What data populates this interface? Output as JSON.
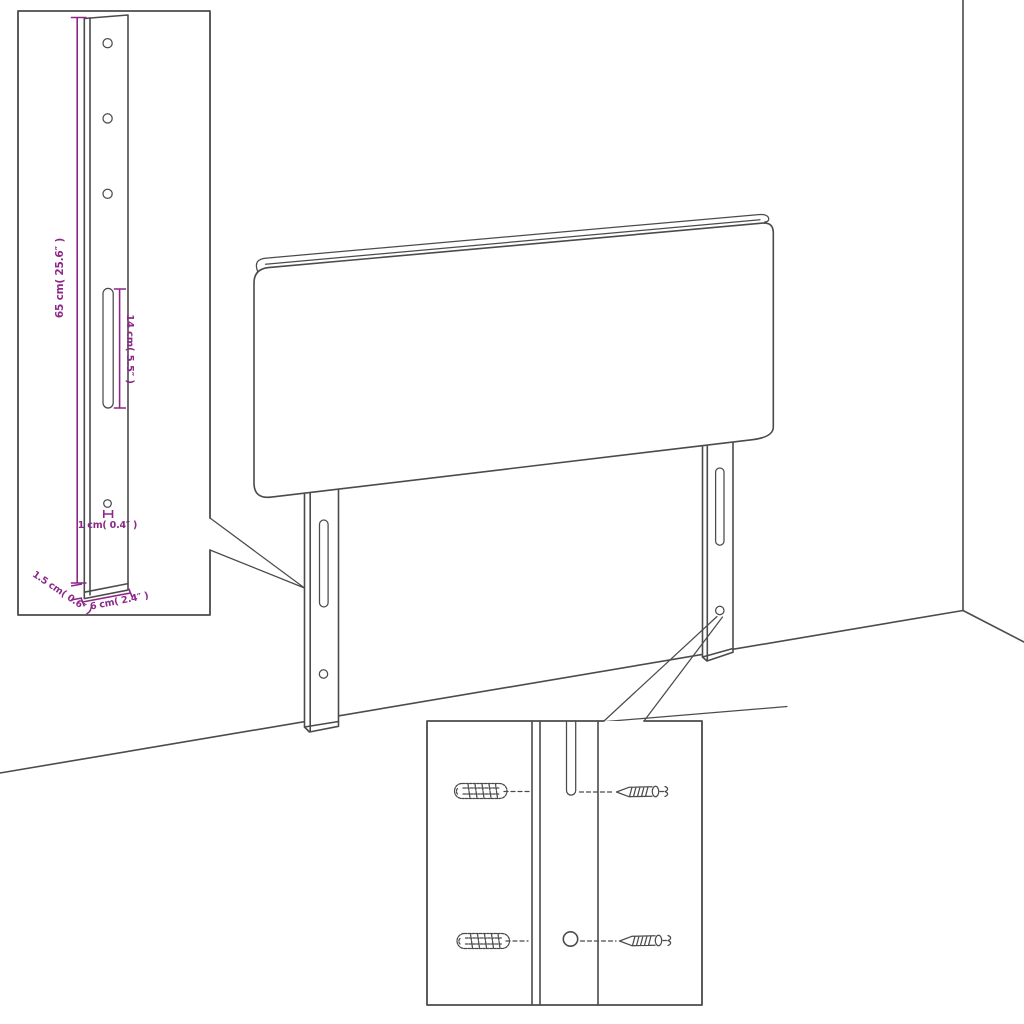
{
  "diagram": {
    "kind": "headboard-mounting-dimension-diagram",
    "colors": {
      "line": "#4b4b4b",
      "dimension": "#8c2888",
      "background": "#ffffff"
    },
    "leg_detail": {
      "height_label": "65 cm( 25.6″ )",
      "slot_label": "14 cm( 5.5″ )",
      "hole_label": "1 cm( 0.4″ )",
      "thickness_label": "1.5 cm( 0.6″ )",
      "width_label": "6 cm( 2.4″ )"
    },
    "hardware_detail": {
      "parts": [
        "wall-plug",
        "screw"
      ]
    }
  }
}
